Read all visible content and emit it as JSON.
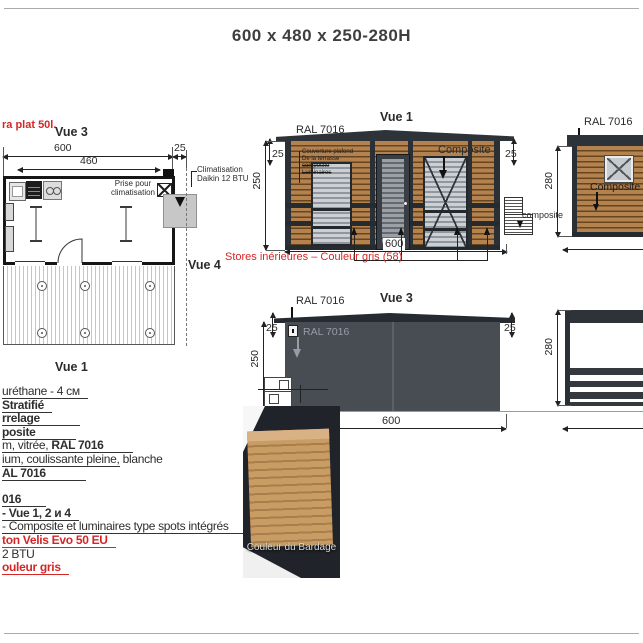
{
  "title": "600 x 480 x 250-280H",
  "plan": {
    "heater_note": "ra plat 50l.",
    "vue3": "Vue 3",
    "vue1": "Vue 1",
    "vue4": "Vue 4",
    "dim600": "600",
    "dim460": "460",
    "dim25": "25",
    "prise_l1": "Prise pour",
    "prise_l2": "climatisation",
    "clim_l1": "Climatisation",
    "clim_l2": "Daikin 12 BTU",
    "win1": "100 x 200",
    "win2": "85 x 195",
    "win3": "100 x 200"
  },
  "vue1": {
    "label": "Vue 1",
    "ral": "RAL 7016",
    "composite": "Composite",
    "note_l1": "Couverture plafond",
    "note_l2": "De la terrasse",
    "note_l3": "composite",
    "note_l4": "Luminaires",
    "dim25l": "25",
    "dim25r": "25",
    "dim250": "250",
    "dim600": "600",
    "stairs": "composite",
    "stores_note": "Stores inérieures – Couleur gris (58)"
  },
  "vue2": {
    "ral": "RAL 7016",
    "composite": "Composite",
    "dim280": "280"
  },
  "vue3": {
    "label": "Vue 3",
    "ral": "RAL 7016",
    "ral_inner": "RAL 7016",
    "dim25l": "25",
    "dim25r": "25",
    "dim250": "250",
    "dim600": "600"
  },
  "vue4": {
    "dim280": "280"
  },
  "photo": {
    "caption": "Couleur du Bardage"
  },
  "specs": {
    "lines": [
      {
        "a": "uréthane - 4 см"
      },
      {
        "a": "Stratifié"
      },
      {
        "a": "rrelage"
      },
      {
        "a": "posite"
      },
      {
        "a": "m, vitrée, ",
        "b": "RAL 7016"
      },
      {
        "a": "ium, coulissante pleine,",
        "b": " blanche"
      },
      {
        "a": "AL 7016"
      },
      {
        "a": "016"
      },
      {
        "a": "- Vue 1, 2 и 4"
      },
      {
        "a": "- Composite et luminaires type spots intégrés"
      },
      {
        "a": "ton Velis Evo 50 EU"
      },
      {
        "a": "2 BTU"
      },
      {
        "a": "ouleur gris"
      }
    ]
  },
  "colors": {
    "accent_red": "#d32727",
    "wood": "#b4824f",
    "frame_dark": "#2e3339",
    "facade_gray": "#484d54"
  }
}
